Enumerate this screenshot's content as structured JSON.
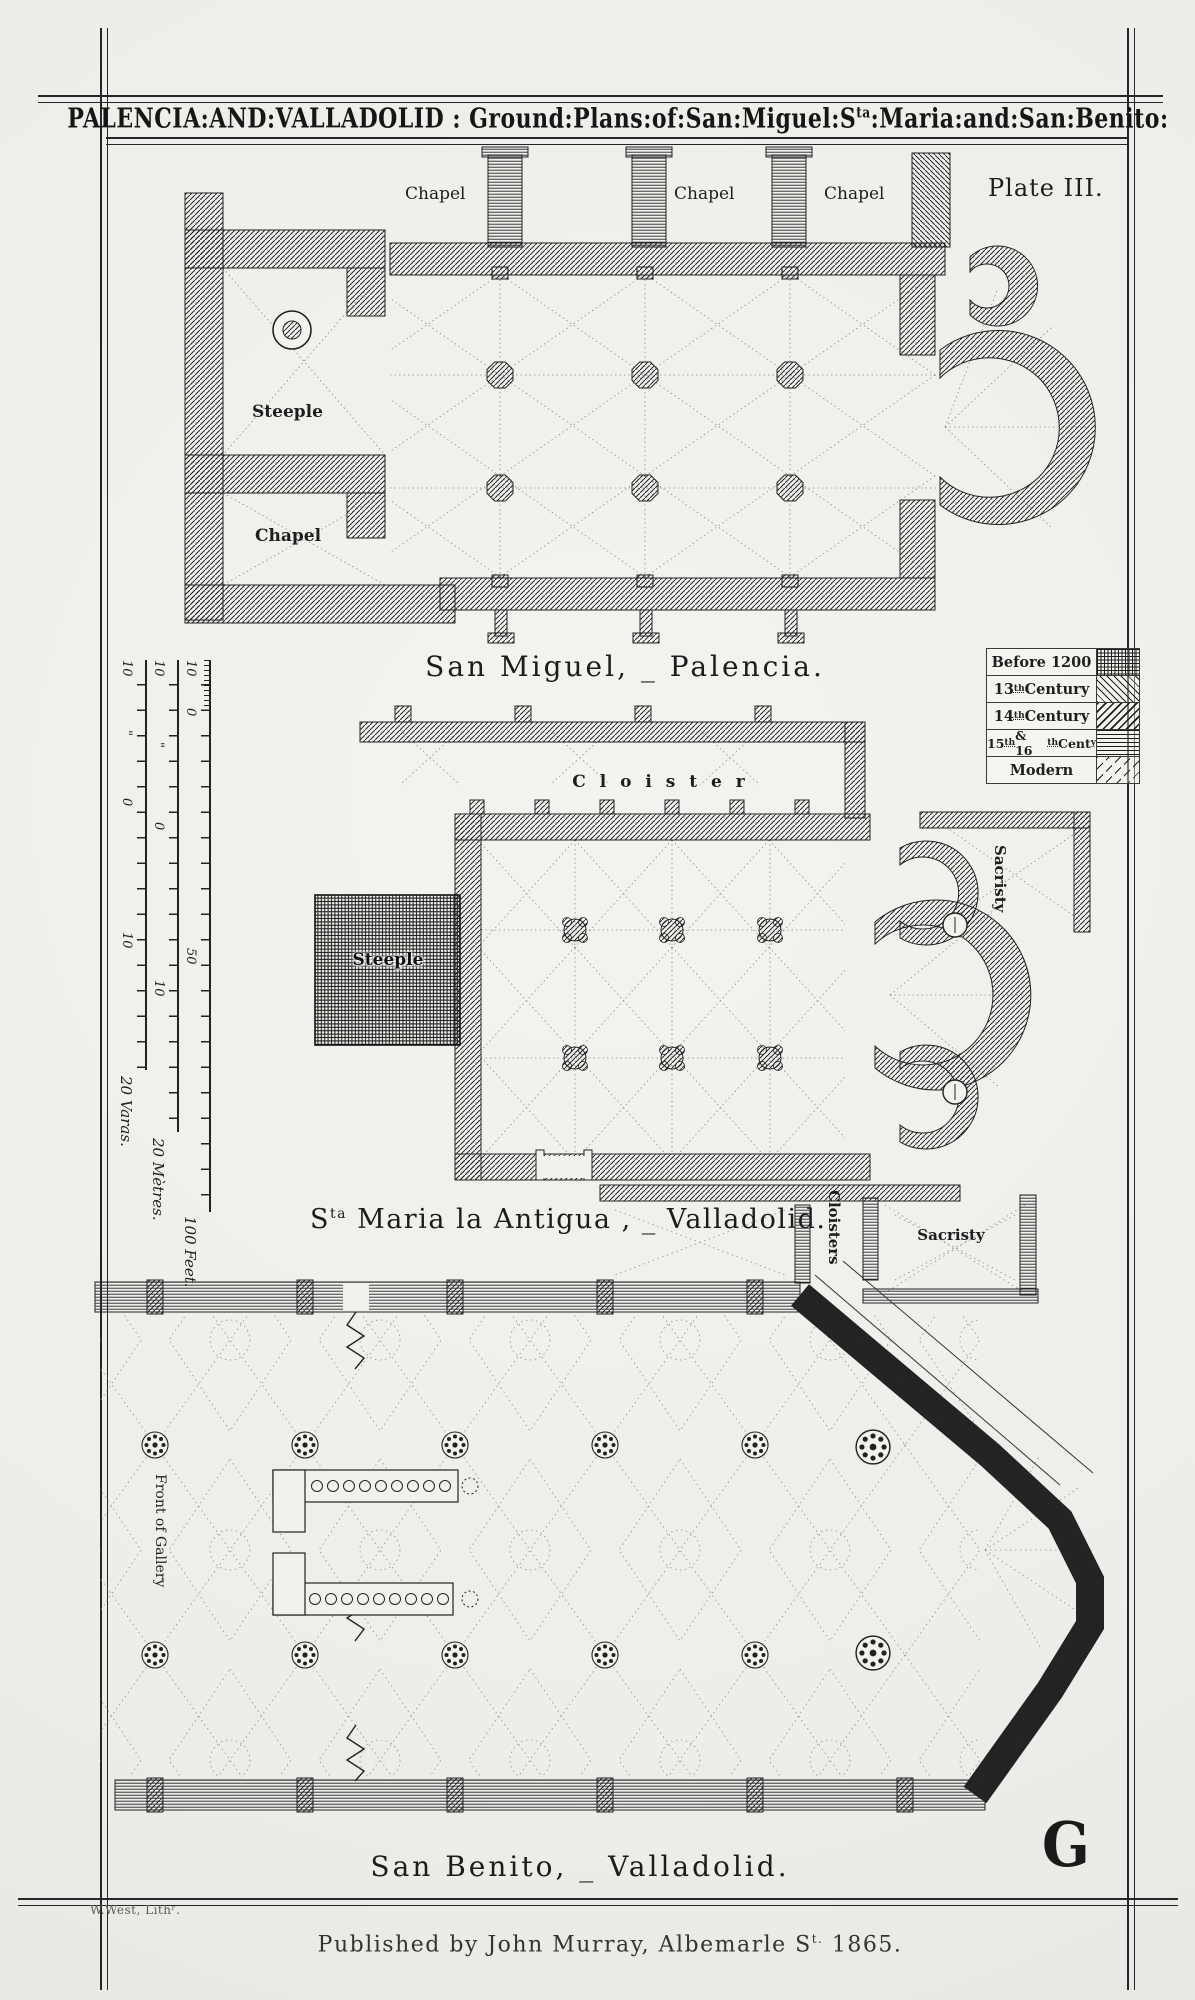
{
  "colors": {
    "paper": "#f1f0ec",
    "ink": "#26262a"
  },
  "title": {
    "a": "PALENCIA:AND:VALLADOLID",
    "sep": " : ",
    "b": "Ground:Plans:of:San:Miguel:S",
    "sup": "ta",
    "c": ":Maria:and:San:Benito:"
  },
  "plate_label": "Plate III.",
  "legend": {
    "r1": "Before 1200",
    "r2a": "13",
    "r2b": "th",
    "r2c": " Century",
    "r3a": "14",
    "r3b": "th",
    "r3c": " Century",
    "r4a": "15",
    "r4b": "th",
    "r4c": " & 16",
    "r4d": "th",
    "r4e": " Cent",
    "r4f": "y",
    "r5": "Modern"
  },
  "san_miguel": {
    "chapel1": "Chapel",
    "chapel2": "Chapel",
    "chapel3": "Chapel",
    "steeple": "Steeple",
    "chapel_left": "Chapel",
    "caption": "San Miguel, _ Palencia."
  },
  "sta_maria": {
    "cloister": "C l o i s t e r",
    "sacristy": "Sacristy",
    "steeple": "Steeple",
    "caption_a": "S",
    "caption_sup": "ta",
    "caption_b": " Maria la Antigua , _ Valladolid."
  },
  "san_benito": {
    "cloisters": "Cloisters",
    "sacristy": "Sacristy",
    "front_of_gallery": "Front of Gallery",
    "caption": "San Benito, _ Valladolid."
  },
  "scales": {
    "varas": {
      "n1": "10",
      "n2": "\"",
      "n3": "0",
      "n4": "10",
      "label": "20 Varas."
    },
    "metres": {
      "n1": "10",
      "n2": "\"",
      "n3": "0",
      "n4": "10",
      "label": "20 Mètres."
    },
    "feet": {
      "n1": "10",
      "n2": "0",
      "n3": "50",
      "label": "100 Feet."
    }
  },
  "credits": {
    "lith": "W.West, Lithʳ.",
    "imprint_a": "Published by John Murray, Albemarle S",
    "imprint_sup": "t.",
    "imprint_b": " 1865.",
    "monogram": "G"
  }
}
